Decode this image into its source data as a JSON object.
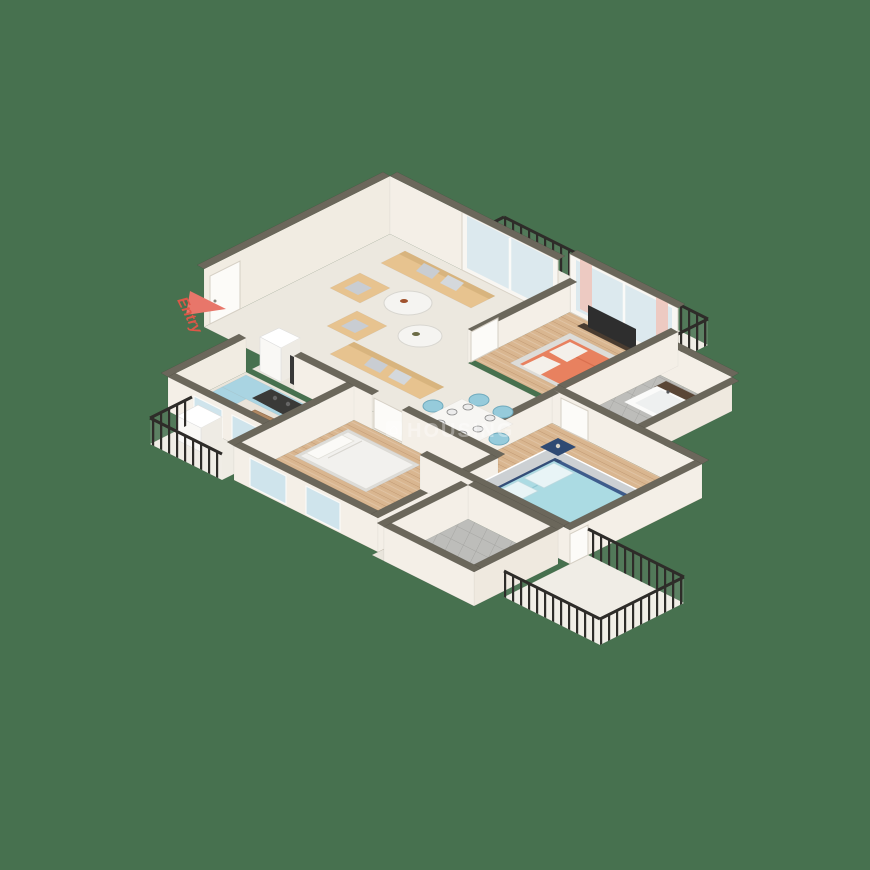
{
  "scene": {
    "type": "isometric-3d-floor-plan",
    "description": "3D rendered apartment floor plan on plain green background",
    "rooms": [
      {
        "name": "living-dining-room",
        "floor": "cream-tile",
        "furniture": [
          "3-seat-sofa-tan",
          "2-seat-sofa-tan",
          "armchair-tan",
          "armchair-tan",
          "round-marble-coffee-table",
          "round-marble-coffee-table",
          "dining-table-white",
          "6-dining-chairs-lightblue",
          "tv-panel",
          "fridge"
        ]
      },
      {
        "name": "kitchen",
        "floor": "cream-tile",
        "furniture": [
          "l-shaped-counter-lightblue",
          "cooktop-dark",
          "floor-mat-brown"
        ]
      },
      {
        "name": "master-bedroom",
        "floor": "wood",
        "furniture": [
          "double-bed-orange",
          "tv-console-dark",
          "sliding-window"
        ]
      },
      {
        "name": "bedroom-blue",
        "floor": "wood",
        "furniture": [
          "double-bed-navy-lightblue",
          "gray-rug",
          "nightstand",
          "nightstand",
          "blue-bench"
        ]
      },
      {
        "name": "bedroom-white",
        "floor": "wood",
        "furniture": [
          "single-bed-white",
          "desk-white",
          "desk-lamp"
        ]
      },
      {
        "name": "master-bathroom",
        "floor": "gray-tile",
        "furniture": [
          "bathtub",
          "washbasin",
          "toilet",
          "wardrobe-darkwood"
        ]
      },
      {
        "name": "bathroom",
        "floor": "gray-tile",
        "furniture": [
          "toilet",
          "washbasin"
        ]
      },
      {
        "name": "balcony-top",
        "floor": "cream",
        "furniture": [
          "iron-railing"
        ]
      },
      {
        "name": "balcony-bottom-right",
        "floor": "cream-marble",
        "furniture": [
          "iron-railing"
        ]
      },
      {
        "name": "utility-balcony-left",
        "floor": "cream",
        "furniture": [
          "iron-railing",
          "washing-machine"
        ]
      }
    ]
  },
  "labels": {
    "entry": "Entry"
  },
  "watermark": {
    "text": "HOUSING",
    "logo_glyph": "⌂"
  },
  "palette": {
    "background": "#47714f",
    "wall_face": "#f4efe7",
    "wall_top": "#6b675b",
    "floor_cream": "#ece8df",
    "floor_wood": "#d9b690",
    "floor_gray": "#bdbdba",
    "railing": "#2e2c29",
    "sofa_tan": "#e7c38f",
    "bed_orange": "#e8815f",
    "bed_navy": "#3e5c8c",
    "bed_lightblue": "#abdbe3",
    "chair_lightblue": "#96cbdb",
    "counter_lightblue": "#a9d4e2",
    "accent_red": "#dd5748",
    "glass": "#dce9ee"
  }
}
